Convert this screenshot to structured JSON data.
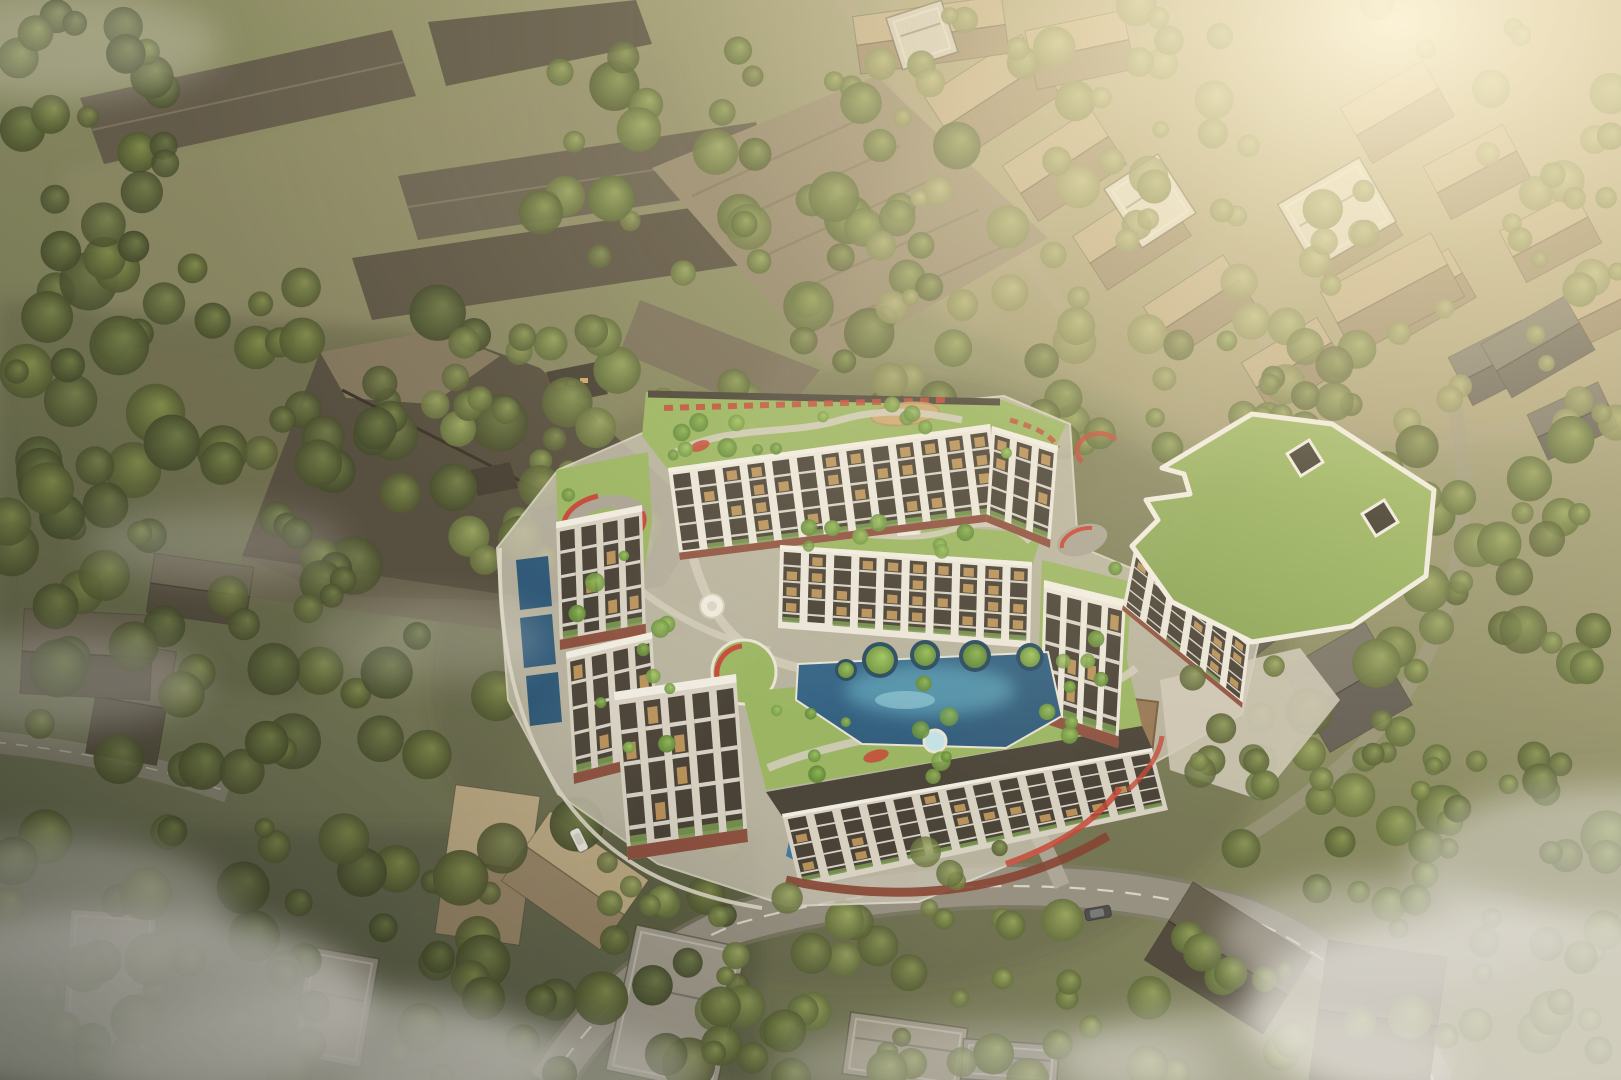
{
  "palette": {
    "ground_top": "#b9ae8a",
    "ground_mid": "#7e8158",
    "ground_bottom": "#4f553f",
    "complex_white": "#ece8df",
    "complex_shadowwhite": "#d6d1c5",
    "facade_dark": "#38322a",
    "window_lit": "#c99a58",
    "planter_green": "#6d8f46",
    "maroon": "#7c3526",
    "red_accent": "#c2382a",
    "charcoal": "#3a352c",
    "lawn": "#92b25a",
    "roof_green_big": "#8cab55",
    "path_gray": "#cfcabb",
    "wall_light": "#ddd8ca",
    "pool_deep": "#1c4c72",
    "pool_mid": "#2e6f9e",
    "pool_light": "#62b9d2",
    "road": "#8e897d",
    "road_shoulder": "#7b766b",
    "road_marking": "#efece0",
    "deck_brown": "#8f6e4b",
    "playground_tan": "#c8a36b",
    "fog": "#e9e7e3",
    "sun_glow": "#fff6dc",
    "school_roof_dark": "#474033",
    "school_roof_mid": "#5a5344",
    "school_roof_tan": "#8d8066"
  },
  "scene": {
    "tree_layers": [
      {
        "layer": "forest-left",
        "seed": 101,
        "region": [
          0,
          260,
          510,
          520
        ],
        "count": 90,
        "pal": "dark",
        "rmin": 12,
        "rmax": 30,
        "front": false
      },
      {
        "layer": "forest-topleft",
        "seed": 102,
        "region": [
          0,
          0,
          200,
          280
        ],
        "count": 22,
        "pal": "dark",
        "rmin": 10,
        "rmax": 24,
        "front": false
      },
      {
        "layer": "forest-topcenter",
        "seed": 103,
        "region": [
          540,
          40,
          430,
          380
        ],
        "count": 55,
        "pal": "mid",
        "rmin": 10,
        "rmax": 26,
        "front": false
      },
      {
        "layer": "forest-topright",
        "seed": 104,
        "region": [
          880,
          0,
          741,
          440
        ],
        "count": 95,
        "pal": "hazy",
        "rmin": 8,
        "rmax": 22,
        "front": false
      },
      {
        "layer": "forest-right",
        "seed": 105,
        "region": [
          1360,
          420,
          261,
          460
        ],
        "count": 42,
        "pal": "mid",
        "rmin": 10,
        "rmax": 26,
        "front": false
      },
      {
        "layer": "forest-bottomleft",
        "seed": 106,
        "region": [
          0,
          820,
          740,
          260
        ],
        "count": 70,
        "pal": "dark",
        "rmin": 10,
        "rmax": 28,
        "front": false
      },
      {
        "layer": "forest-bottomcenter",
        "seed": 107,
        "region": [
          690,
          920,
          560,
          160
        ],
        "count": 40,
        "pal": "mid",
        "rmin": 9,
        "rmax": 22,
        "front": false
      },
      {
        "layer": "forest-bottomright",
        "seed": 108,
        "region": [
          1230,
          680,
          391,
          400
        ],
        "count": 45,
        "pal": "mid",
        "rmin": 9,
        "rmax": 24,
        "front": false
      },
      {
        "layer": "glade-centerwest",
        "seed": 109,
        "region": [
          420,
          330,
          240,
          240
        ],
        "count": 28,
        "pal": "mid",
        "rmin": 10,
        "rmax": 24,
        "front": false
      },
      {
        "layer": "glade-centereast",
        "seed": 110,
        "region": [
          1030,
          330,
          330,
          120
        ],
        "count": 26,
        "pal": "mid",
        "rmin": 9,
        "rmax": 20,
        "front": false
      },
      {
        "layer": "roof-north",
        "seed": 111,
        "region": [
          650,
          400,
          360,
          66
        ],
        "count": 14,
        "pal": "bright",
        "rmin": 5,
        "rmax": 10,
        "front": true
      },
      {
        "layer": "roof-mid",
        "seed": 112,
        "region": [
          780,
          515,
          260,
          45
        ],
        "count": 9,
        "pal": "bright",
        "rmin": 5,
        "rmax": 9,
        "front": true
      },
      {
        "layer": "roof-west",
        "seed": 113,
        "region": [
          560,
          470,
          130,
          290
        ],
        "count": 12,
        "pal": "bright",
        "rmin": 5,
        "rmax": 10,
        "front": true
      },
      {
        "layer": "roof-south",
        "seed": 114,
        "region": [
          770,
          680,
          340,
          100
        ],
        "count": 12,
        "pal": "bright",
        "rmin": 5,
        "rmax": 10,
        "front": true
      },
      {
        "layer": "roof-east",
        "seed": 115,
        "region": [
          1040,
          560,
          110,
          180
        ],
        "count": 8,
        "pal": "bright",
        "rmin": 5,
        "rmax": 9,
        "front": true
      },
      {
        "layer": "overhang-south",
        "seed": 116,
        "region": [
          600,
          840,
          420,
          90
        ],
        "count": 16,
        "pal": "mid",
        "rmin": 8,
        "rmax": 16,
        "front": true
      },
      {
        "layer": "plaza-east",
        "seed": 117,
        "region": [
          1160,
          660,
          180,
          140
        ],
        "count": 12,
        "pal": "mid",
        "rmin": 8,
        "rmax": 16,
        "front": true
      }
    ],
    "facades": [
      {
        "id": "north-block",
        "p": [
          [
            668,
            468
          ],
          [
            990,
            424
          ],
          [
            1002,
            520
          ],
          [
            680,
            560
          ]
        ],
        "bays": 13,
        "tone": "sun",
        "maroon_base": true,
        "lit": 0.5,
        "seed": 11
      },
      {
        "id": "northeast-block",
        "p": [
          [
            992,
            426
          ],
          [
            1058,
            446
          ],
          [
            1050,
            548
          ],
          [
            986,
            522
          ]
        ],
        "bays": 3,
        "tone": "sun",
        "maroon_base": true,
        "lit": 0.4,
        "seed": 12
      },
      {
        "id": "mid-block-pool",
        "p": [
          [
            780,
            545
          ],
          [
            1032,
            562
          ],
          [
            1030,
            648
          ],
          [
            778,
            628
          ]
        ],
        "bays": 10,
        "tone": "sun",
        "maroon_base": false,
        "lit": 0.45,
        "seed": 13
      },
      {
        "id": "west-tower-upper",
        "p": [
          [
            556,
            522
          ],
          [
            642,
            505
          ],
          [
            646,
            634
          ],
          [
            560,
            650
          ]
        ],
        "bays": 4,
        "tone": "shade",
        "maroon_base": true,
        "lit": 0.3,
        "seed": 14
      },
      {
        "id": "west-tower-lower",
        "p": [
          [
            566,
            652
          ],
          [
            652,
            632
          ],
          [
            660,
            762
          ],
          [
            574,
            784
          ]
        ],
        "bays": 4,
        "tone": "shade",
        "maroon_base": true,
        "lit": 0.25,
        "seed": 15
      },
      {
        "id": "southwest-tower",
        "p": [
          [
            614,
            692
          ],
          [
            736,
            674
          ],
          [
            748,
            842
          ],
          [
            628,
            860
          ]
        ],
        "bays": 5,
        "tone": "shade",
        "maroon_base": true,
        "lit": 0.3,
        "seed": 16
      },
      {
        "id": "south-block",
        "p": [
          [
            782,
            814
          ],
          [
            1152,
            748
          ],
          [
            1168,
            810
          ],
          [
            800,
            888
          ]
        ],
        "bays": 14,
        "tone": "shade",
        "maroon_base": false,
        "lit": 0.25,
        "seed": 17
      },
      {
        "id": "east-block",
        "p": [
          [
            1044,
            580
          ],
          [
            1126,
            600
          ],
          [
            1118,
            748
          ],
          [
            1040,
            722
          ]
        ],
        "bays": 4,
        "tone": "sun",
        "maroon_base": true,
        "lit": 0.35,
        "seed": 18
      },
      {
        "id": "green-building-facade",
        "p": [
          [
            1134,
            550
          ],
          [
            1250,
            642
          ],
          [
            1242,
            708
          ],
          [
            1122,
            610
          ]
        ],
        "bays": 6,
        "tone": "sun",
        "maroon_base": true,
        "lit": 0.3,
        "seed": 19
      }
    ],
    "houses": [
      {
        "x": 935,
        "y": 60,
        "w": 115,
        "h": 72,
        "a": -33,
        "c": "tan"
      },
      {
        "x": 1012,
        "y": 132,
        "w": 105,
        "h": 66,
        "a": -33,
        "c": "tan"
      },
      {
        "x": 1082,
        "y": 204,
        "w": 100,
        "h": 64,
        "a": -33,
        "c": "tan"
      },
      {
        "x": 1152,
        "y": 276,
        "w": 95,
        "h": 60,
        "a": -33,
        "c": "tan"
      },
      {
        "x": 1350,
        "y": 80,
        "w": 95,
        "h": 64,
        "a": -30,
        "c": "tan"
      },
      {
        "x": 1432,
        "y": 142,
        "w": 90,
        "h": 60,
        "a": -28,
        "c": "tan"
      },
      {
        "x": 1508,
        "y": 208,
        "w": 85,
        "h": 58,
        "a": -28,
        "c": "tan"
      },
      {
        "x": 1564,
        "y": 282,
        "w": 78,
        "h": 52,
        "a": -26,
        "c": "tan"
      },
      {
        "x": 1306,
        "y": 204,
        "w": 88,
        "h": 58,
        "a": -31,
        "c": "tan"
      },
      {
        "x": 1384,
        "y": 266,
        "w": 84,
        "h": 56,
        "a": -30,
        "c": "tan"
      },
      {
        "x": 1250,
        "y": 336,
        "w": 88,
        "h": 58,
        "a": -31,
        "c": "tan"
      },
      {
        "x": 1456,
        "y": 336,
        "w": 82,
        "h": 54,
        "a": -27,
        "c": "gray"
      },
      {
        "x": 1534,
        "y": 396,
        "w": 78,
        "h": 50,
        "a": -25,
        "c": "gray"
      },
      {
        "x": 1330,
        "y": 258,
        "w": 125,
        "h": 72,
        "a": -28,
        "c": "tan"
      },
      {
        "x": 856,
        "y": 6,
        "w": 150,
        "h": 58,
        "a": -8,
        "c": "tan"
      },
      {
        "x": 1030,
        "y": 20,
        "w": 100,
        "h": 60,
        "a": -12,
        "c": "tan"
      },
      {
        "x": 1190,
        "y": 572,
        "w": 120,
        "h": 78,
        "a": -38,
        "c": "gray"
      },
      {
        "x": 1300,
        "y": 640,
        "w": 95,
        "h": 95,
        "a": -30,
        "c": "gray"
      },
      {
        "x": 1158,
        "y": 912,
        "w": 140,
        "h": 92,
        "a": 32,
        "c": "dark"
      },
      {
        "x": 1318,
        "y": 948,
        "w": 120,
        "h": 140,
        "a": 8,
        "c": "dark"
      },
      {
        "x": 445,
        "y": 790,
        "w": 85,
        "h": 150,
        "a": 8,
        "c": "tan"
      },
      {
        "x": 515,
        "y": 838,
        "w": 120,
        "h": 85,
        "a": 35,
        "c": "tan"
      },
      {
        "x": 95,
        "y": 645,
        "w": 72,
        "h": 115,
        "a": 10,
        "c": "dark"
      },
      {
        "x": 22,
        "y": 612,
        "w": 130,
        "h": 85,
        "a": 3,
        "c": "dark"
      },
      {
        "x": 150,
        "y": 560,
        "w": 100,
        "h": 60,
        "a": 8,
        "c": "dark"
      },
      {
        "x": 1490,
        "y": 316,
        "w": 96,
        "h": 62,
        "a": -30,
        "c": "gray"
      }
    ],
    "house_palettes": {
      "tan": {
        "up": "#b7a47e",
        "low": "#8f7c5e",
        "ridge": "#6b5a40"
      },
      "gray": {
        "up": "#6e6a5f",
        "low": "#55514a",
        "ridge": "#3a362e"
      },
      "dark": {
        "up": "#5a5444",
        "low": "#423d31",
        "ridge": "#2b261d"
      }
    },
    "flat_buildings": [
      {
        "x": 620,
        "y": 935,
        "w": 112,
        "h": 148,
        "a": 12,
        "c": "#9b968b"
      },
      {
        "x": 66,
        "y": 912,
        "w": 86,
        "h": 136,
        "a": 4,
        "c": "#8e897d"
      },
      {
        "x": 846,
        "y": 1020,
        "w": 118,
        "h": 62,
        "a": 8,
        "c": "#97927f"
      },
      {
        "x": 962,
        "y": 1042,
        "w": 96,
        "h": 40,
        "a": 4,
        "c": "#8e8a7e"
      },
      {
        "x": 1118,
        "y": 166,
        "w": 64,
        "h": 70,
        "a": -33,
        "c": "#ddd7c7"
      },
      {
        "x": 1290,
        "y": 176,
        "w": 94,
        "h": 74,
        "a": -30,
        "c": "#d8d2c2"
      },
      {
        "x": 893,
        "y": 8,
        "w": 58,
        "h": 54,
        "a": -18,
        "c": "#cdc7b8"
      },
      {
        "x": 300,
        "y": 952,
        "w": 70,
        "h": 110,
        "a": 10,
        "c": "#8a8578"
      }
    ],
    "vehicles": [
      {
        "kind": "car",
        "x": 1098,
        "y": 913,
        "a": -10,
        "len": 26,
        "wid": 12,
        "body": "#3f3f41",
        "top": "#6e7072"
      },
      {
        "kind": "van",
        "x": 579,
        "y": 840,
        "a": 64,
        "len": 24,
        "wid": 11,
        "body": "#e9e7e0",
        "top": "#cfcdc6"
      }
    ],
    "tree_palettes": {
      "dark": [
        "gdark0",
        "gdark1",
        "gdark2"
      ],
      "mid": [
        "gmid0",
        "gmid1",
        "gmid2"
      ],
      "hazy": [
        "ghazy0",
        "ghazy1",
        "ghazy2"
      ],
      "bright": [
        "gbright0",
        "gbright1",
        "gbright2"
      ]
    }
  }
}
